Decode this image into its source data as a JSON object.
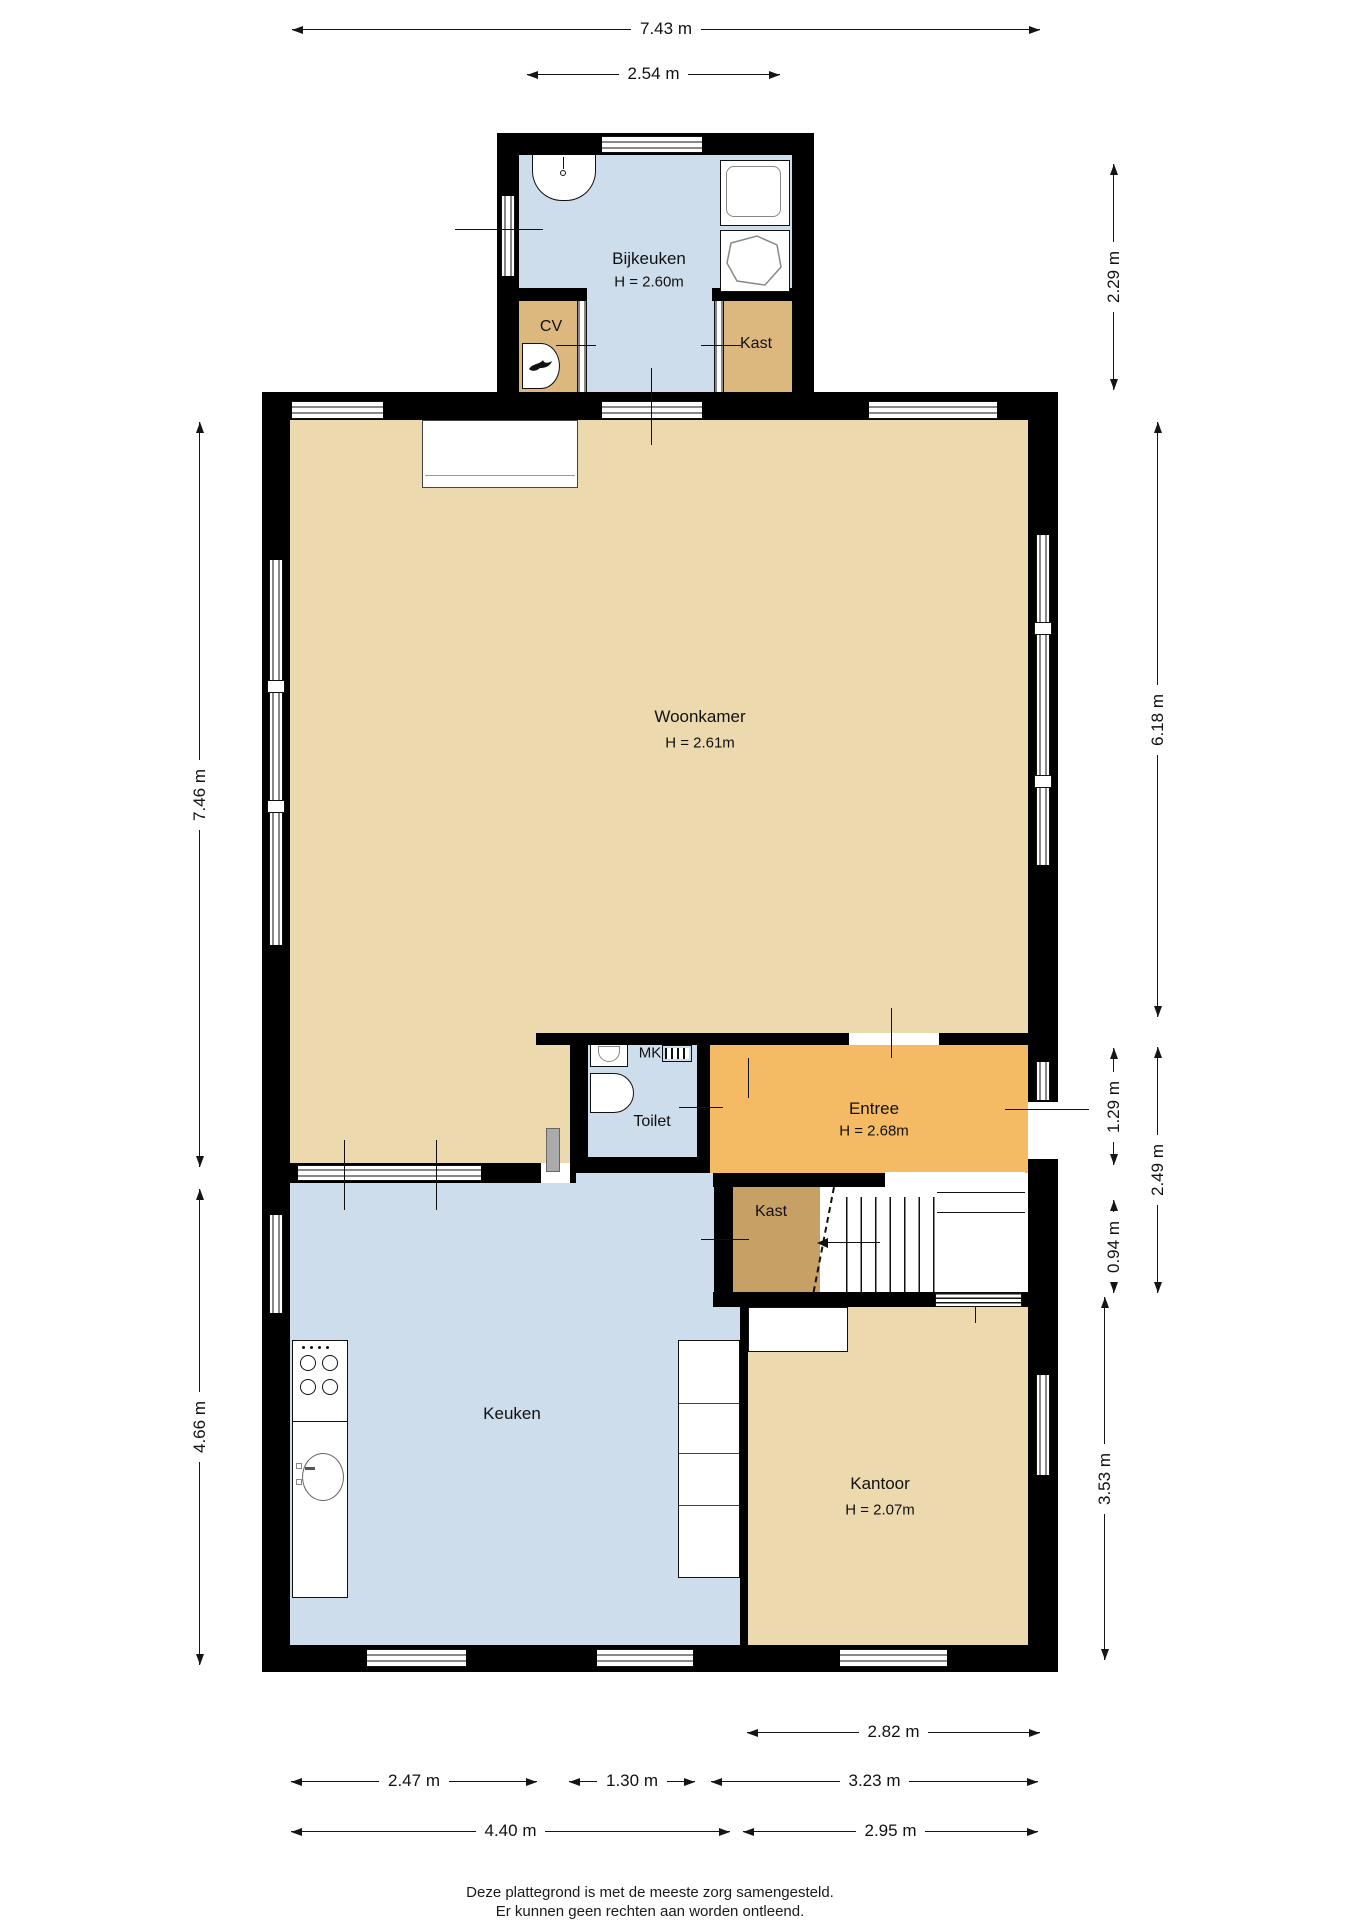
{
  "plan": {
    "rooms": {
      "bijkeuken": {
        "label": "Bijkeuken",
        "height": "H = 2.60m"
      },
      "cv": {
        "label": "CV"
      },
      "kast_boven": {
        "label": "Kast"
      },
      "woonkamer": {
        "label": "Woonkamer",
        "height": "H = 2.61m"
      },
      "toilet": {
        "label": "Toilet"
      },
      "mk": {
        "label": "MK"
      },
      "entree": {
        "label": "Entree",
        "height": "H = 2.68m"
      },
      "kast_hal": {
        "label": "Kast"
      },
      "keuken": {
        "label": "Keuken"
      },
      "kantoor": {
        "label": "Kantoor",
        "height": "H = 2.07m"
      }
    },
    "dimensions": {
      "top_total": "7.43 m",
      "top_bijkeuken": "2.54 m",
      "right_bijkeuken": "2.29 m",
      "left_woonkamer": "7.46 m",
      "right_woonkamer": "6.18 m",
      "right_entree": "1.29 m",
      "right_entree_total": "2.49 m",
      "right_trap": "0.94 m",
      "right_kantoor": "3.53 m",
      "left_keuken": "4.66 m",
      "bottom_kantoor_boven": "2.82 m",
      "bottom_keuken_links": "2.47 m",
      "bottom_midden": "1.30 m",
      "bottom_kantoor": "3.23 m",
      "bottom_links_totaal": "4.40 m",
      "bottom_rechts_totaal": "2.95 m"
    },
    "footer": {
      "line1": "Deze plattegrond is met de meeste zorg samengesteld.",
      "line2": "Er kunnen geen rechten aan worden ontleend."
    },
    "colors": {
      "room_blue": "#cdddec",
      "room_tan": "#ecd9ae",
      "room_tan_dark": "#dcb87e",
      "room_orange": "#f4ba64",
      "room_brown": "#c7a066",
      "wall": "#000000"
    }
  }
}
